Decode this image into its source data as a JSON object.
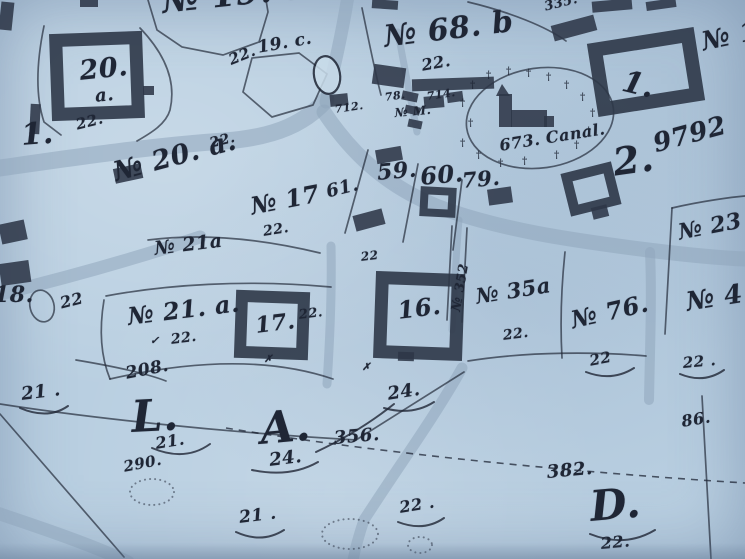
{
  "colors": {
    "paper": "#b9cfe1",
    "paper_light": "#c9dcea",
    "ink": "#1f2635",
    "road": "#8fa6bc",
    "building": "#2e3748"
  },
  "map": {
    "cross_glyph": "†",
    "labels": [
      {
        "t": "№ 19. a.",
        "x": 160,
        "y": -18,
        "s": 34,
        "r": -6
      },
      {
        "t": "22.",
        "x": 226,
        "y": 52,
        "s": 15,
        "r": -22
      },
      {
        "t": "19. c.",
        "x": 256,
        "y": 38,
        "s": 17,
        "r": -10
      },
      {
        "t": "20.",
        "x": 78,
        "y": 56,
        "s": 27,
        "r": -6
      },
      {
        "t": "a.",
        "x": 94,
        "y": 86,
        "s": 18,
        "r": -6
      },
      {
        "t": "22.",
        "x": 74,
        "y": 116,
        "s": 15,
        "r": -14
      },
      {
        "t": "1.",
        "x": 20,
        "y": 118,
        "s": 30,
        "r": -4
      },
      {
        "t": "№ 68. b",
        "x": 382,
        "y": 20,
        "s": 30,
        "r": -7
      },
      {
        "t": "22.",
        "x": 420,
        "y": 56,
        "s": 16,
        "r": -10
      },
      {
        "t": "335.",
        "x": 543,
        "y": 0,
        "s": 13,
        "r": -14
      },
      {
        "t": "№ 1",
        "x": 699,
        "y": 28,
        "s": 26,
        "r": -12
      },
      {
        "t": "1.",
        "x": 627,
        "y": 64,
        "s": 30,
        "r": 14
      },
      {
        "t": "712.",
        "x": 334,
        "y": 103,
        "s": 11,
        "r": -8
      },
      {
        "t": "78.",
        "x": 384,
        "y": 91,
        "s": 11,
        "r": -8
      },
      {
        "t": "714.",
        "x": 426,
        "y": 90,
        "s": 11,
        "r": -8
      },
      {
        "t": "№ M.",
        "x": 394,
        "y": 106,
        "s": 12,
        "r": -5
      },
      {
        "t": "673. Canal.",
        "x": 498,
        "y": 136,
        "s": 16,
        "r": -9
      },
      {
        "t": "2.",
        "x": 610,
        "y": 140,
        "s": 38,
        "r": -8
      },
      {
        "t": "9792",
        "x": 650,
        "y": 130,
        "s": 26,
        "r": -15
      },
      {
        "t": "59.",
        "x": 376,
        "y": 160,
        "s": 22,
        "r": -5
      },
      {
        "t": "60.",
        "x": 419,
        "y": 162,
        "s": 24,
        "r": -5,
        "w": 800
      },
      {
        "t": "79.",
        "x": 461,
        "y": 168,
        "s": 21,
        "r": -5
      },
      {
        "t": "61.",
        "x": 324,
        "y": 182,
        "s": 18,
        "r": -14
      },
      {
        "t": "№ 17",
        "x": 248,
        "y": 192,
        "s": 24,
        "r": -11
      },
      {
        "t": "№ 20. a.",
        "x": 110,
        "y": 158,
        "s": 27,
        "r": -15
      },
      {
        "t": "22.",
        "x": 208,
        "y": 136,
        "s": 14,
        "r": -14
      },
      {
        "t": "22.",
        "x": 262,
        "y": 224,
        "s": 14,
        "r": -9
      },
      {
        "t": "№ 21a",
        "x": 153,
        "y": 238,
        "s": 19,
        "r": -7
      },
      {
        "t": "22",
        "x": 360,
        "y": 250,
        "s": 12,
        "r": -7
      },
      {
        "t": "18.",
        "x": -6,
        "y": 282,
        "s": 22,
        "r": 0
      },
      {
        "t": "22",
        "x": 58,
        "y": 294,
        "s": 16,
        "r": -14
      },
      {
        "t": "№ 21. a.",
        "x": 126,
        "y": 302,
        "s": 24,
        "r": -7
      },
      {
        "t": "22.",
        "x": 170,
        "y": 332,
        "s": 14,
        "r": -7
      },
      {
        "t": "17.",
        "x": 254,
        "y": 313,
        "s": 22,
        "r": -7
      },
      {
        "t": "22.",
        "x": 298,
        "y": 308,
        "s": 13,
        "r": -7
      },
      {
        "t": "16.",
        "x": 396,
        "y": 296,
        "s": 24,
        "r": -7
      },
      {
        "t": "№ 352",
        "x": 449,
        "y": 310,
        "s": 13,
        "r": -80
      },
      {
        "t": "№ 35a",
        "x": 474,
        "y": 284,
        "s": 21,
        "r": -9
      },
      {
        "t": "22.",
        "x": 502,
        "y": 328,
        "s": 14,
        "r": -7
      },
      {
        "t": "№ 76.",
        "x": 568,
        "y": 306,
        "s": 24,
        "r": -13
      },
      {
        "t": "22",
        "x": 588,
        "y": 352,
        "s": 15,
        "r": -11
      },
      {
        "t": "№ 23",
        "x": 676,
        "y": 220,
        "s": 22,
        "r": -11
      },
      {
        "t": "№ 4",
        "x": 684,
        "y": 288,
        "s": 26,
        "r": -9
      },
      {
        "t": "22 .",
        "x": 682,
        "y": 354,
        "s": 15,
        "r": -5
      },
      {
        "t": "86.",
        "x": 680,
        "y": 412,
        "s": 16,
        "r": -9
      },
      {
        "t": "382.",
        "x": 546,
        "y": 462,
        "s": 18,
        "r": -5
      },
      {
        "t": "D.",
        "x": 588,
        "y": 482,
        "s": 42,
        "r": -5
      },
      {
        "t": "22.",
        "x": 600,
        "y": 534,
        "s": 16,
        "r": -5
      },
      {
        "t": "21 .",
        "x": 20,
        "y": 384,
        "s": 18,
        "r": -7
      },
      {
        "t": "208.",
        "x": 124,
        "y": 364,
        "s": 17,
        "r": -11
      },
      {
        "t": "L.",
        "x": 130,
        "y": 392,
        "s": 44,
        "r": -3
      },
      {
        "t": "21.",
        "x": 154,
        "y": 434,
        "s": 16,
        "r": -9
      },
      {
        "t": "290.",
        "x": 122,
        "y": 458,
        "s": 15,
        "r": -11
      },
      {
        "t": "A.",
        "x": 258,
        "y": 404,
        "s": 44,
        "r": -5
      },
      {
        "t": "24.",
        "x": 268,
        "y": 450,
        "s": 18,
        "r": -7
      },
      {
        "t": "356.",
        "x": 333,
        "y": 428,
        "s": 18,
        "r": -5
      },
      {
        "t": "24.",
        "x": 386,
        "y": 384,
        "s": 18,
        "r": -9
      },
      {
        "t": "21 .",
        "x": 238,
        "y": 508,
        "s": 17,
        "r": -7
      },
      {
        "t": "22 .",
        "x": 398,
        "y": 498,
        "s": 16,
        "r": -9
      },
      {
        "t": "✗",
        "x": 264,
        "y": 354,
        "s": 10,
        "r": 0
      },
      {
        "t": "✗",
        "x": 362,
        "y": 362,
        "s": 10,
        "r": 0
      },
      {
        "t": "✓",
        "x": 150,
        "y": 334,
        "s": 11,
        "r": 0
      }
    ],
    "crosses": [
      {
        "x": 460,
        "y": 98
      },
      {
        "x": 470,
        "y": 80
      },
      {
        "x": 486,
        "y": 70
      },
      {
        "x": 506,
        "y": 66
      },
      {
        "x": 526,
        "y": 68
      },
      {
        "x": 546,
        "y": 72
      },
      {
        "x": 564,
        "y": 80
      },
      {
        "x": 580,
        "y": 92
      },
      {
        "x": 590,
        "y": 108
      },
      {
        "x": 586,
        "y": 126
      },
      {
        "x": 574,
        "y": 140
      },
      {
        "x": 554,
        "y": 150
      },
      {
        "x": 468,
        "y": 118
      },
      {
        "x": 460,
        "y": 138
      },
      {
        "x": 476,
        "y": 150
      },
      {
        "x": 498,
        "y": 158
      },
      {
        "x": 522,
        "y": 156
      }
    ]
  }
}
